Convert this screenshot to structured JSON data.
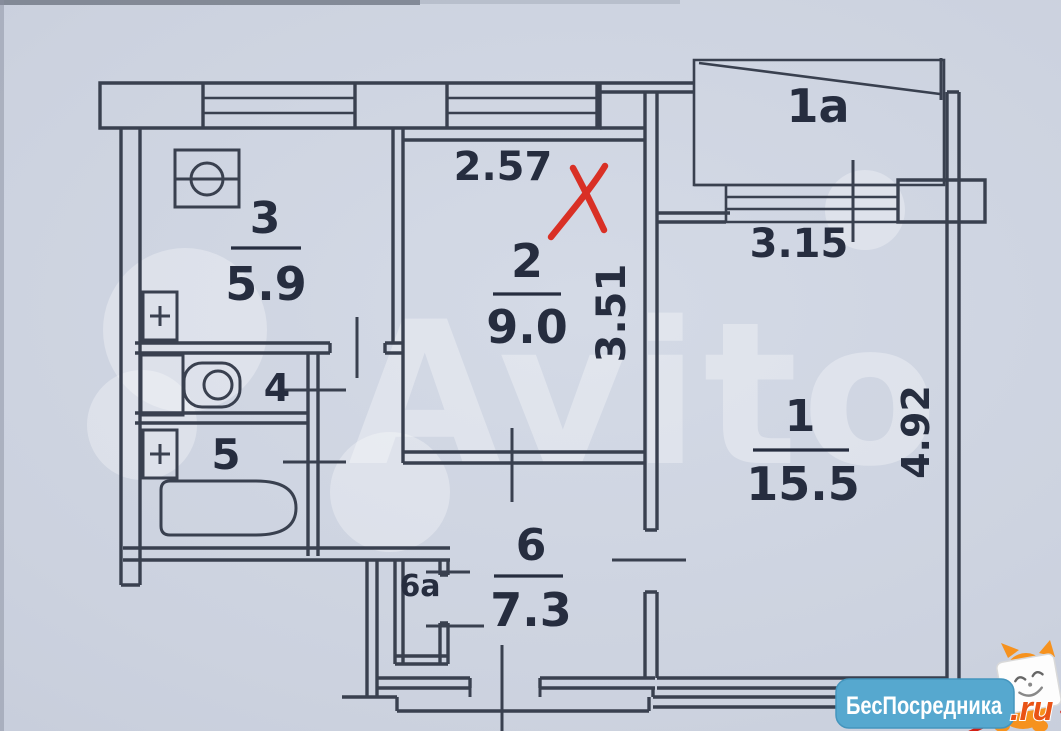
{
  "plan": {
    "rooms": [
      {
        "key": "living-room",
        "number": "1",
        "area": "15.5"
      },
      {
        "key": "balcony",
        "number": "1a",
        "area": ""
      },
      {
        "key": "bedroom",
        "number": "2",
        "area": "9.0"
      },
      {
        "key": "kitchen",
        "number": "3",
        "area": "5.9"
      },
      {
        "key": "wc",
        "number": "4",
        "area": ""
      },
      {
        "key": "bathroom",
        "number": "5",
        "area": ""
      },
      {
        "key": "hallway",
        "number": "6",
        "area": "7.3"
      },
      {
        "key": "closet",
        "number": "6a",
        "area": ""
      }
    ],
    "dimensions": {
      "room2_width": "2.57",
      "room2_depth": "3.51",
      "balcony_window": "3.15",
      "room1_depth": "4.92"
    },
    "icons": {
      "stove": "stove-icon",
      "toilet": "toilet-icon",
      "bathtub": "bathtub-icon",
      "vent": "plus-vent-icon",
      "red_x": "hand-drawn-x-mark"
    }
  },
  "watermarks": {
    "avito": "Avito",
    "badge": {
      "text": "БесПосредника",
      "suffix": ".ru"
    }
  },
  "colors": {
    "paper": "#ccd2df",
    "ink": "#39404f",
    "label_ink": "#262d3f",
    "red_mark": "#d93025",
    "badge_blue": "#56a8cf",
    "badge_orange": "#e95316",
    "mascot_orange": "#f6921e"
  }
}
